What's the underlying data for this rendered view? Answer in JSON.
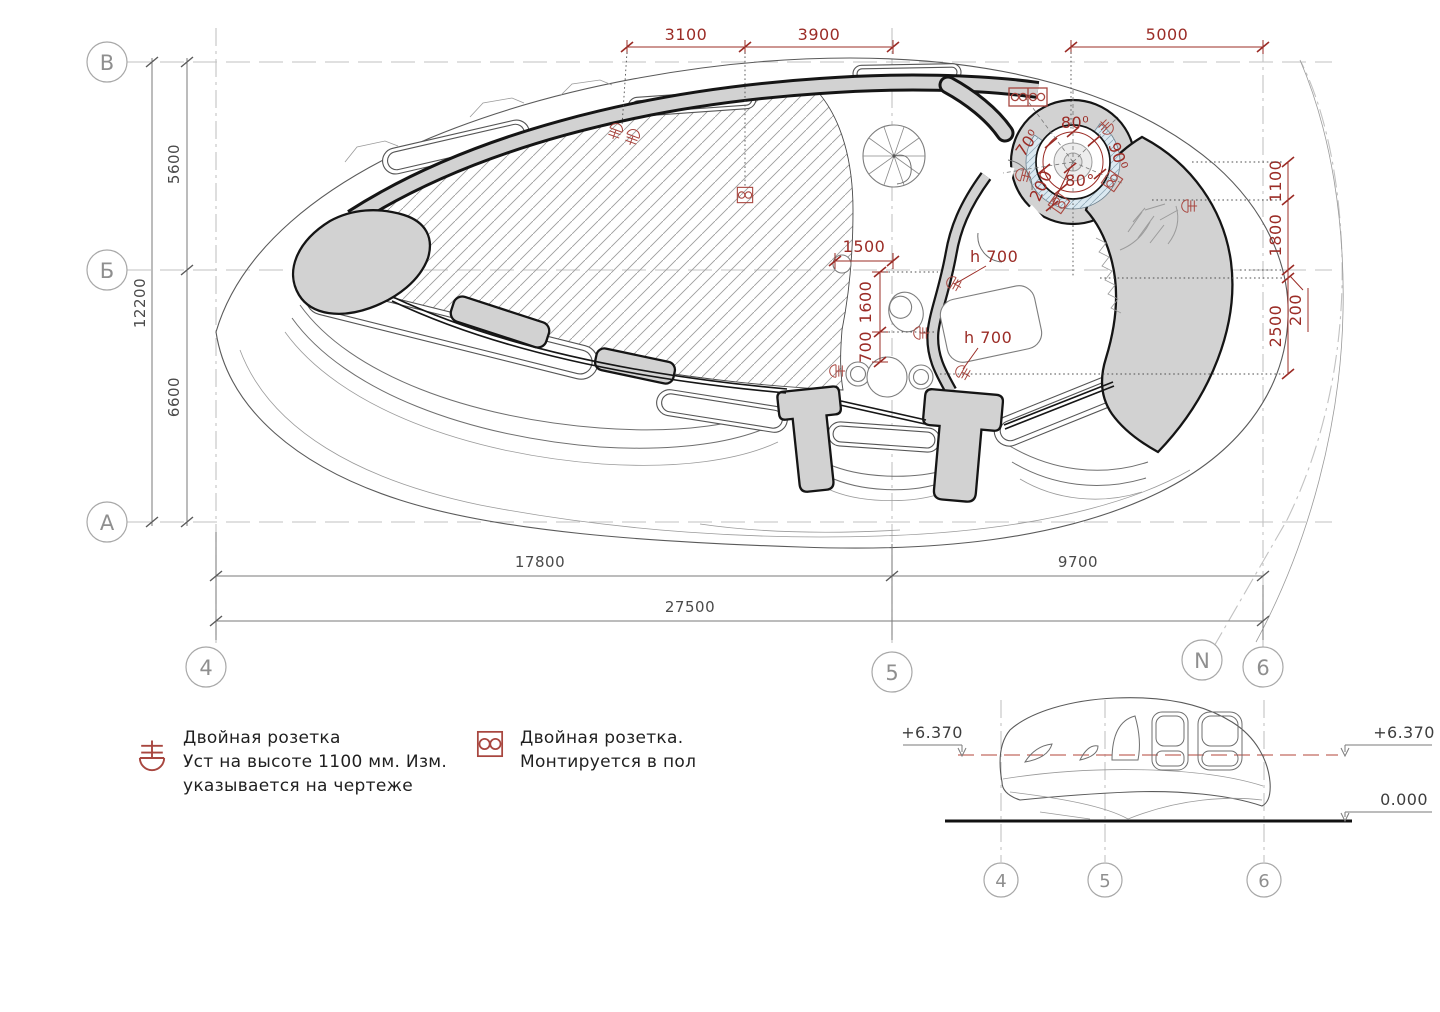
{
  "title": "Floor plan with electrical socket layout",
  "colors": {
    "annotation_red": "#9b2c26",
    "wall_gray": "#d2d2d2",
    "glazing_blue": "#dbe9f1",
    "line_dark": "#151515",
    "dim_gray": "#4a4a4a",
    "axis_gray": "#8f8f8f"
  },
  "plan": {
    "axes_rows": [
      "В",
      "Б",
      "А"
    ],
    "axes_cols": [
      "4",
      "5",
      "N",
      "6"
    ],
    "dims_top": [
      "3100",
      "3900",
      "5000"
    ],
    "dims_left": [
      "5600",
      "12200",
      "6600"
    ],
    "dims_right": [
      "1100",
      "1800",
      "200",
      "2500"
    ],
    "dims_bottom": [
      "17800",
      "9700",
      "27500"
    ],
    "inner_dims": {
      "w1500": "1500",
      "v1600": "1600",
      "v700": "700"
    },
    "height_marks": [
      "h 700",
      "h 700"
    ],
    "room": {
      "angles": [
        "80⁰",
        "70⁰",
        "90⁰",
        "80°"
      ],
      "radial_dim": "200"
    }
  },
  "legend": {
    "items": [
      {
        "symbol": "wall-double-socket",
        "lines": [
          "Двойная розетка",
          "Уст на высоте 1100 мм. Изм.",
          "указывается на чертеже"
        ]
      },
      {
        "symbol": "floor-double-socket",
        "lines": [
          "Двойная розетка.",
          "Монтируется в пол"
        ]
      }
    ]
  },
  "elevation": {
    "level_left": "+6.370",
    "level_right": "+6.370",
    "level_zero": "0.000",
    "axes": [
      "4",
      "5",
      "6"
    ]
  }
}
